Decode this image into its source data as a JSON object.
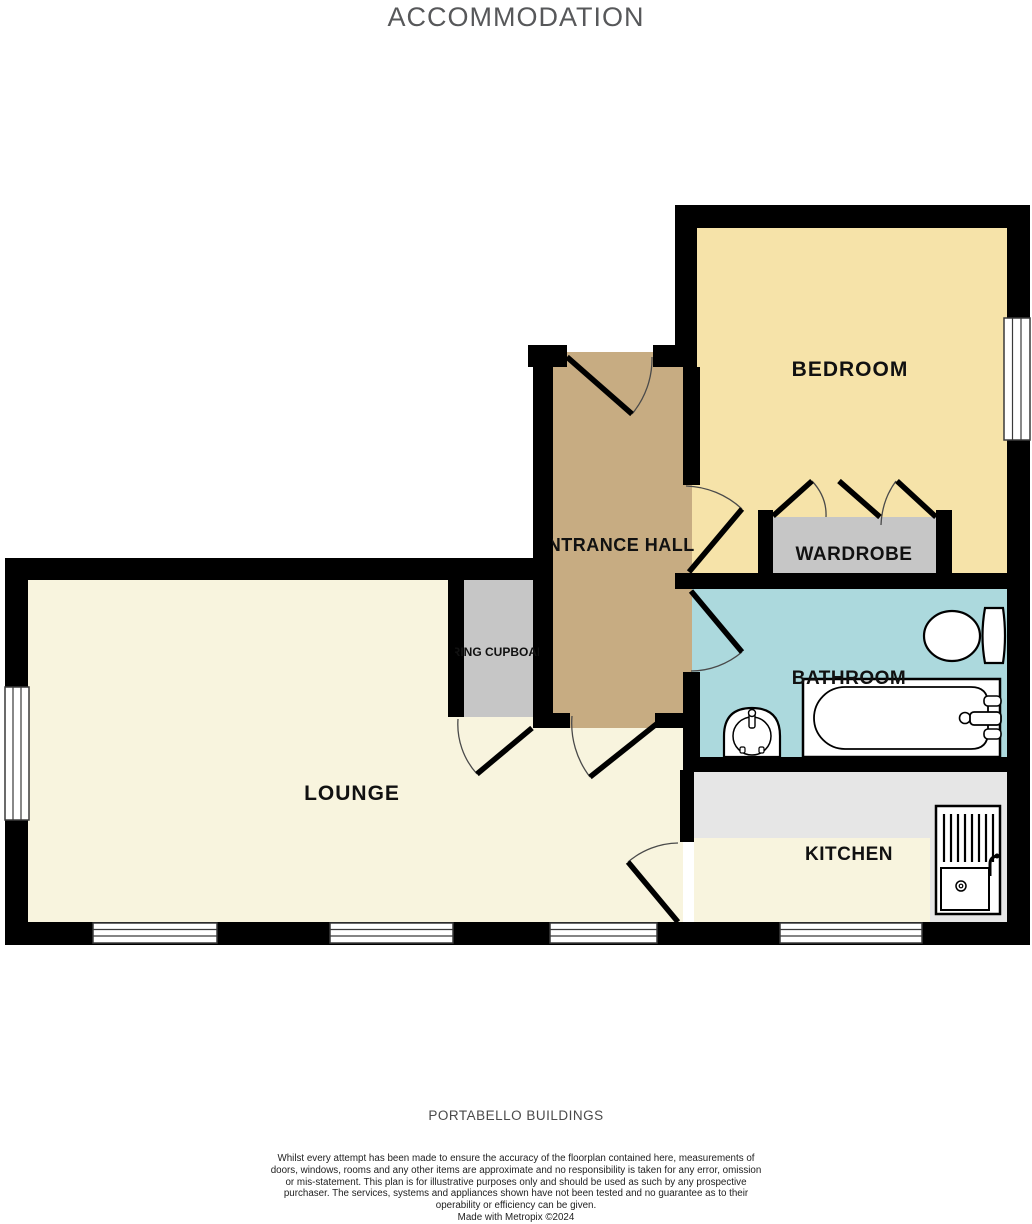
{
  "title": "ACCOMMODATION",
  "rooms": {
    "bedroom": "BEDROOM",
    "entrance_hall": "ENTRANCE HALL",
    "wardrobe": "WARDROBE",
    "bathroom": "BATHROOM",
    "airing_cupboard": "AIRING CUPBOARD",
    "lounge": "LOUNGE",
    "kitchen": "KITCHEN"
  },
  "fixtures": [
    "toilet",
    "bathtub",
    "pedestal-basin",
    "kitchen-sink-drainer",
    "wardrobe-bifold-doors"
  ],
  "colors": {
    "wall": "#000000",
    "bedroom_fill": "#F6E3A9",
    "hall_fill": "#C7AC82",
    "bathroom_fill": "#ACD9DD",
    "lounge_fill": "#F8F4DE",
    "kitchen_fill": "#F8F4DE",
    "cupboard_fill": "#C6C6C6",
    "wardrobe_fill": "#C6C6C6",
    "counter_fill": "#E6E6E6",
    "window_fill": "#FFFFFF",
    "title_color": "#57585A",
    "label_color": "#111111"
  },
  "footer": {
    "property_name": "PORTABELLO BUILDINGS",
    "disclaimer": "Whilst every attempt has been made to ensure the accuracy of the floorplan contained here, measurements of doors, windows, rooms and any other items are approximate and no responsibility is taken for any error, omission or mis-statement. This plan is for illustrative purposes only and should be used as such by any prospective purchaser. The services, systems and appliances shown have not been tested and no guarantee as to their operability or efficiency can be given.",
    "credit": "Made with Metropix ©2024"
  }
}
